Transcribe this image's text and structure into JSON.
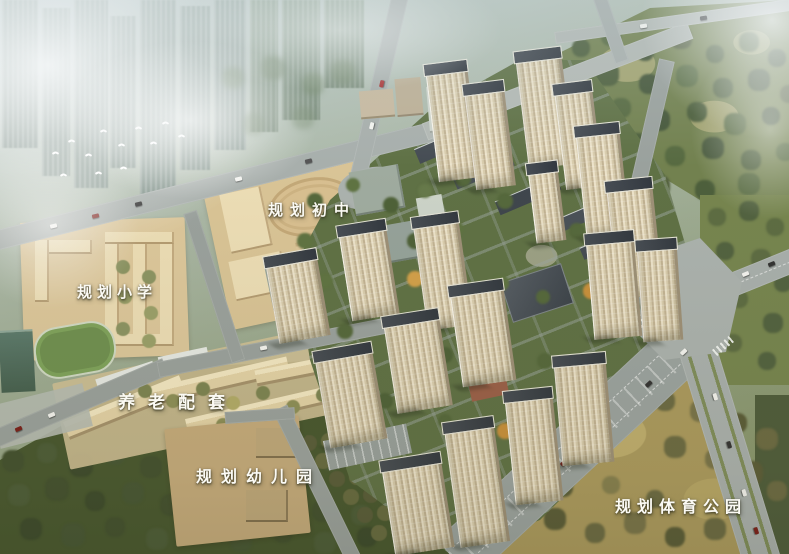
{
  "scene": {
    "type": "aerial-masterplan-rendering",
    "labels": {
      "middle_school": "规划初中",
      "primary_school": "规划小学",
      "elderly_care": "养老配套",
      "kindergarten": "规划幼儿园",
      "sports_park": "规划体育公园"
    },
    "palette": {
      "haze": "#e9eff0",
      "distant_city": "#9cada7",
      "road": "#a8afac",
      "school_ground": "#d9c69b",
      "track_oval": "#d8bf90",
      "tower_facade": "#e0d5ba",
      "tower_roof": "#3d434a",
      "tree_dark": "#42502f",
      "tree_olive": "#6b6a43",
      "park_ground": "#ab9a5e",
      "estate_ground": "#5f7145",
      "label_text": "#fbfaf4"
    }
  }
}
